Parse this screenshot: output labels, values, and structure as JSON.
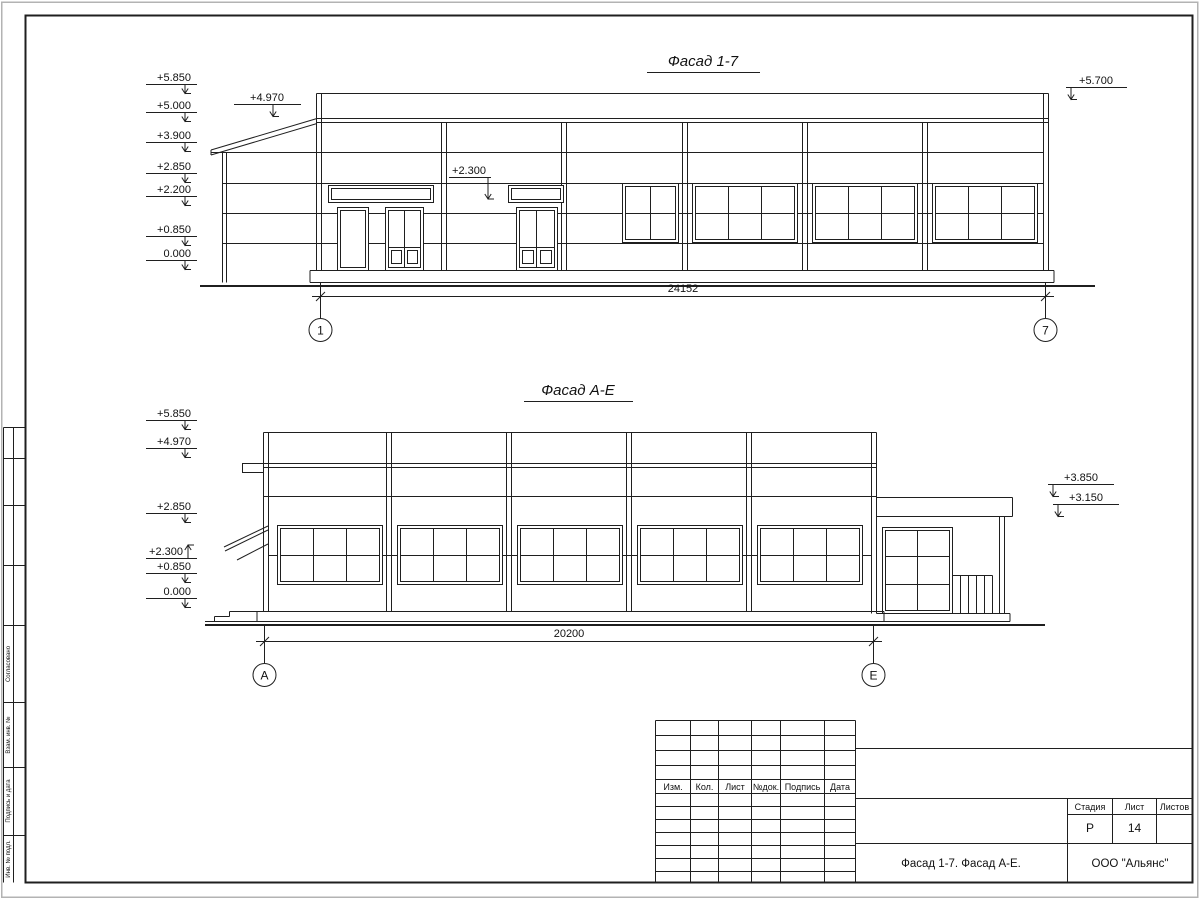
{
  "drawing": {
    "facade1": {
      "title": "Фасад 1-7",
      "elevations_left": [
        "+5.850",
        "+5.000",
        "+3.900",
        "+2.850",
        "+2.200",
        "+0.850",
        "0.000"
      ],
      "elevation_canopy": "+4.970",
      "elevation_door": "+2.300",
      "elevation_right": "+5.700",
      "dimension": "24152",
      "axis_left": "1",
      "axis_right": "7"
    },
    "facade2": {
      "title": "Фасад А-Е",
      "elevations_left": [
        "+5.850",
        "+4.970",
        "+2.850",
        "+2.300",
        "+0.850",
        "0.000"
      ],
      "elevations_right": [
        "+3.850",
        "+3.150"
      ],
      "dimension": "20200",
      "axis_left": "А",
      "axis_right": "Е"
    },
    "title_block": {
      "revision_headers": [
        "Изм.",
        "Кол.",
        "Лист",
        "№док.",
        "Подпись",
        "Дата"
      ],
      "stage_label": "Стадия",
      "sheet_label": "Лист",
      "sheets_label": "Листов",
      "stage_value": "Р",
      "sheet_value": "14",
      "sheets_value": "",
      "drawing_name": "Фасад 1-7. Фасад А-Е.",
      "organization": "ООО \"Альянс\""
    },
    "side_column": {
      "labels": [
        "Согласовано",
        "Взам. инв. №",
        "Подпись и дата",
        "Инв. № подл."
      ]
    }
  }
}
